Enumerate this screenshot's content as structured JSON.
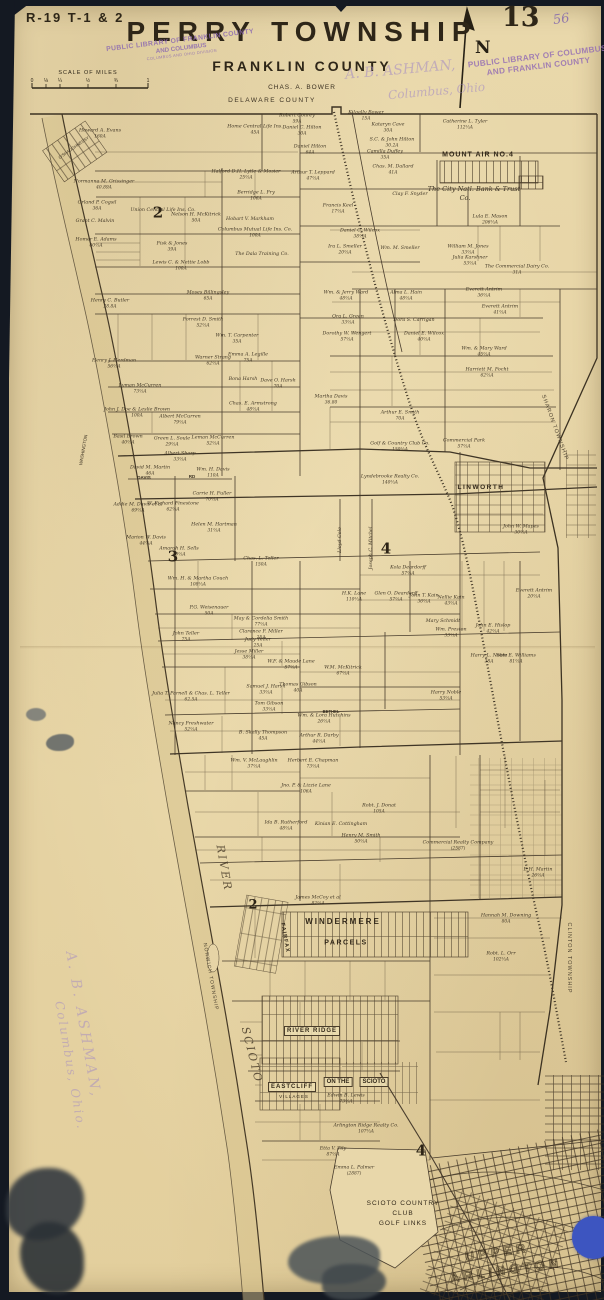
{
  "header": {
    "plate_ref": "R-19 T-1 & 2",
    "page_number": "13",
    "handwritten_number": "56",
    "title": "PERRY TOWNSHIP",
    "subtitle": "FRANKLIN COUNTY",
    "surveyor": "CHAS. A. BOWER",
    "north_label": "N",
    "county_line_label": "DELAWARE COUNTY"
  },
  "scale": {
    "caption": "SCALE OF MILES",
    "ticks": [
      "0",
      "⅛",
      "¼",
      "½",
      "¾",
      "1"
    ]
  },
  "stamps": {
    "library_left_1": "PUBLIC LIBRARY OF FRANKLIN COUNTY",
    "library_left_2": "AND COLUMBUS",
    "library_left_3": "COLUMBUS AND OHIO DIVISION",
    "library_right_1": "PUBLIC LIBRARY OF COLUMBUS",
    "library_right_2": "AND FRANKLIN COUNTY",
    "dealer_1": "A. B. ASHMAN,",
    "dealer_2": "Columbus, Ohio",
    "watermark_1": "A. B. ASHMAN,",
    "watermark_2": "Columbus, Ohio."
  },
  "map": {
    "accent_colors": {
      "paper": "#e6d4a6",
      "ink": "#3b3122",
      "stamp_purple": "#8d6bb1",
      "blue_dot": "#3d55c0"
    },
    "labels": [
      {
        "t": "SHARON TOWNSHIP",
        "x": 554,
        "y": 428,
        "cls": "boundary",
        "fs": 5.5,
        "rot": 70,
        "ls": 1
      },
      {
        "t": "CLINTON TOWNSHIP",
        "x": 568,
        "y": 958,
        "cls": "boundary",
        "fs": 5.5,
        "rot": 90,
        "ls": 1
      },
      {
        "t": "NORWICH TOWNSHIP",
        "x": 210,
        "y": 977,
        "cls": "boundary",
        "fs": 5,
        "rot": 80,
        "ls": 1
      },
      {
        "t": "RIVER",
        "x": 224,
        "y": 868,
        "cls": "river",
        "fs": 11,
        "rot": 80,
        "ls": 2
      },
      {
        "t": "SCIOTO",
        "x": 252,
        "y": 1055,
        "cls": "river",
        "fs": 11,
        "rot": 76,
        "ls": 2
      },
      {
        "t": "WASHINGTON",
        "x": 84,
        "y": 450,
        "cls": "road",
        "fs": 4.5,
        "rot": -80
      },
      {
        "t": "O'SHAUGHNESSY",
        "x": 74,
        "y": 148,
        "cls": "road",
        "fs": 4.2,
        "rot": -35
      },
      {
        "t": "MOUNT AIR NO.4",
        "x": 478,
        "y": 155,
        "cls": "place",
        "fs": 7,
        "ls": 1,
        "bold": 1
      },
      {
        "t": "The City Natl. Bank & Trust",
        "x": 474,
        "y": 189,
        "cls": "script",
        "fs": 6.5
      },
      {
        "t": "Co.",
        "x": 465,
        "y": 198,
        "cls": "script",
        "fs": 6.5
      },
      {
        "t": "LINWORTH",
        "x": 481,
        "y": 488,
        "cls": "place",
        "fs": 6.5,
        "ls": 1.5,
        "bold": 1
      },
      {
        "t": "WINDERMERE",
        "x": 343,
        "y": 922,
        "cls": "place",
        "fs": 8,
        "ls": 2,
        "bold": 1
      },
      {
        "t": "PARCELS",
        "x": 346,
        "y": 943,
        "cls": "place",
        "fs": 7,
        "ls": 1.5,
        "bold": 1
      },
      {
        "t": "FAIRFAX",
        "x": 284,
        "y": 938,
        "cls": "place",
        "fs": 5.5,
        "rot": 80,
        "ls": 1,
        "bold": 1
      },
      {
        "t": "RIVER RIDGE",
        "x": 312,
        "y": 1031,
        "cls": "place",
        "fs": 6,
        "ls": 1,
        "bold": 1,
        "box": 1
      },
      {
        "t": "EASTCLIFF",
        "x": 292,
        "y": 1087,
        "cls": "place",
        "fs": 6,
        "ls": 1,
        "bold": 1,
        "box": 1
      },
      {
        "t": "VILLAGES",
        "x": 294,
        "y": 1097,
        "cls": "place",
        "fs": 4.5,
        "ls": 1
      },
      {
        "t": "ON THE",
        "x": 338,
        "y": 1082,
        "cls": "place",
        "fs": 6,
        "bold": 1,
        "box": 1
      },
      {
        "t": "SCIOTO",
        "x": 374,
        "y": 1082,
        "cls": "place",
        "fs": 6,
        "bold": 1,
        "box": 1
      },
      {
        "t": "SCIOTO COUNTRY",
        "x": 403,
        "y": 1204,
        "cls": "place",
        "fs": 6.5,
        "ls": 1
      },
      {
        "t": "CLUB",
        "x": 403,
        "y": 1214,
        "cls": "place",
        "fs": 6.5,
        "ls": 1
      },
      {
        "t": "GOLF LINKS",
        "x": 403,
        "y": 1224,
        "cls": "place",
        "fs": 6.5,
        "ls": 1
      },
      {
        "t": "UPPER",
        "x": 497,
        "y": 1252,
        "cls": "outline",
        "fs": 13,
        "ls": 4,
        "rot": -8
      },
      {
        "t": "ARLINGTON",
        "x": 506,
        "y": 1270,
        "cls": "outline",
        "fs": 13,
        "ls": 4,
        "rot": -8
      },
      {
        "t": "DAVIS",
        "x": 144,
        "y": 478,
        "cls": "road",
        "fs": 4.5,
        "bold": 1
      },
      {
        "t": "RD",
        "x": 192,
        "y": 477,
        "cls": "road",
        "fs": 4.5,
        "bold": 1
      },
      {
        "t": "BETHEL",
        "x": 331,
        "y": 712,
        "cls": "road",
        "fs": 4.2,
        "bold": 1
      },
      {
        "t": "2",
        "x": 158,
        "y": 213,
        "cls": "section",
        "fs": 15
      },
      {
        "t": "3",
        "x": 173,
        "y": 557,
        "cls": "section",
        "fs": 15
      },
      {
        "t": "4",
        "x": 386,
        "y": 549,
        "cls": "section",
        "fs": 15
      },
      {
        "t": "2",
        "x": 253,
        "y": 905,
        "cls": "section",
        "fs": 13
      },
      {
        "t": "4",
        "x": 421,
        "y": 1151,
        "cls": "section",
        "fs": 15
      }
    ],
    "parcels": [
      {
        "n": "Howard A. Evans",
        "a": "160A",
        "x": 100,
        "y": 134
      },
      {
        "n": "Robert Conrey",
        "a": "59A",
        "x": 297,
        "y": 119
      },
      {
        "n": "Daniel C. Hilton",
        "a": "30A",
        "x": 302,
        "y": 131
      },
      {
        "n": "Daniel Hilton",
        "a": "64A",
        "x": 310,
        "y": 150
      },
      {
        "n": "Arthur T. Leppard",
        "a": "47⅔A",
        "x": 313,
        "y": 176
      },
      {
        "n": "Halford D.H. Lytle & Mosier",
        "a": "25⅔A",
        "x": 246,
        "y": 175
      },
      {
        "n": "Home Central Life Ins.",
        "a": "45A",
        "x": 255,
        "y": 130
      },
      {
        "n": "Kilgally Bower",
        "a": "15A",
        "x": 366,
        "y": 116
      },
      {
        "n": "Kataryn Cave",
        "a": "30A",
        "x": 388,
        "y": 128
      },
      {
        "n": "S.C. & John Hilton",
        "a": "30.2A",
        "x": 392,
        "y": 143
      },
      {
        "n": "Catherine L. Tyler",
        "a": "112⅔A",
        "x": 465,
        "y": 125
      },
      {
        "n": "Camilla Duffey",
        "a": "35A",
        "x": 385,
        "y": 155
      },
      {
        "n": "Chas. M. Dallard",
        "a": "41A",
        "x": 393,
        "y": 170
      },
      {
        "n": "Clay F. Snyder",
        "x": 410,
        "y": 195
      },
      {
        "n": "Berridge L. Fry",
        "a": "106A",
        "x": 256,
        "y": 196
      },
      {
        "n": "Hobart V. Markham",
        "x": 250,
        "y": 220
      },
      {
        "n": "Columbus Mutual Life Ins. Co.",
        "a": "100A",
        "x": 255,
        "y": 233
      },
      {
        "n": "The Dala Training Co.",
        "x": 262,
        "y": 255
      },
      {
        "n": "Union Central Life Ins. Co.",
        "x": 163,
        "y": 211
      },
      {
        "n": "Nelson H. McKitrick",
        "a": "50A",
        "x": 196,
        "y": 218
      },
      {
        "n": "Lewis C. & Nettie Lobb",
        "a": "100A",
        "x": 181,
        "y": 266
      },
      {
        "n": "Normanna M. Grissinger",
        "a": "40.89A",
        "x": 104,
        "y": 185
      },
      {
        "n": "Orland P. Cogsil",
        "a": "36A",
        "x": 97,
        "y": 206
      },
      {
        "n": "Grant C. Malvin",
        "x": 95,
        "y": 222
      },
      {
        "n": "Homer E. Adams",
        "a": "60⅔A",
        "x": 96,
        "y": 243
      },
      {
        "n": "Fisk & Jones",
        "a": "39A",
        "x": 172,
        "y": 247
      },
      {
        "n": "Ira L. Smeller",
        "a": "20⅔A",
        "x": 345,
        "y": 250
      },
      {
        "n": "Wm. M. Smeller",
        "x": 400,
        "y": 249
      },
      {
        "n": "Daniel C. Wilcox",
        "a": "38⅔A",
        "x": 360,
        "y": 234
      },
      {
        "n": "Francis Keel",
        "a": "17⅔A",
        "x": 338,
        "y": 209
      },
      {
        "n": "Lula E. Mason",
        "a": "206⅔A",
        "x": 490,
        "y": 220
      },
      {
        "n": "William M. Jones",
        "a": "33⅔A",
        "x": 468,
        "y": 250
      },
      {
        "n": "Julia Karshner",
        "a": "53⅔A",
        "x": 470,
        "y": 261
      },
      {
        "n": "The Commercial Dairy Co.",
        "a": "31A",
        "x": 517,
        "y": 270
      },
      {
        "n": "Wm. & Jerry Ward",
        "a": "48⅔A",
        "x": 346,
        "y": 296
      },
      {
        "n": "Alma L. Hain",
        "a": "48⅔A",
        "x": 406,
        "y": 296
      },
      {
        "n": "Everett Antrim",
        "a": "36⅔A",
        "x": 484,
        "y": 293
      },
      {
        "n": "Everett Antrim",
        "a": "41⅔A",
        "x": 500,
        "y": 310
      },
      {
        "n": "Ora L. Green",
        "a": "33⅔A",
        "x": 348,
        "y": 320
      },
      {
        "n": "Dora S. Carrigan",
        "x": 414,
        "y": 321
      },
      {
        "n": "Daniel E. Wilcox",
        "a": "40⅔A",
        "x": 424,
        "y": 337
      },
      {
        "n": "Wm. & Mary Ward",
        "a": "45⅔A",
        "x": 484,
        "y": 352
      },
      {
        "n": "Harriett M. Focht",
        "a": "62⅔A",
        "x": 487,
        "y": 373
      },
      {
        "n": "Dorothy W. Wengert",
        "a": "57⅓A",
        "x": 347,
        "y": 337
      },
      {
        "n": "Martha Davis",
        "a": "36.80",
        "x": 331,
        "y": 400
      },
      {
        "n": "Arthur E. Smith",
        "a": "70A",
        "x": 400,
        "y": 416
      },
      {
        "n": "Moses Billingsley",
        "a": "65A",
        "x": 208,
        "y": 296
      },
      {
        "n": "Forrest D. Smith",
        "a": "52⅔A",
        "x": 203,
        "y": 323
      },
      {
        "n": "Wm. T. Carpenter",
        "a": "35A",
        "x": 237,
        "y": 339
      },
      {
        "n": "Emma A. Legille",
        "a": "75A",
        "x": 248,
        "y": 358
      },
      {
        "n": "Bona Harsh",
        "x": 243,
        "y": 380
      },
      {
        "n": "Dave O. Harsh",
        "a": "70A",
        "x": 278,
        "y": 384
      },
      {
        "n": "Chas. E. Armstrong",
        "a": "48⅔A",
        "x": 253,
        "y": 407
      },
      {
        "n": "Henry C. Butler",
        "a": "28.8A",
        "x": 110,
        "y": 304
      },
      {
        "n": "Warner Strang",
        "a": "62⅔A",
        "x": 213,
        "y": 361
      },
      {
        "n": "Henry J. Herdman",
        "a": "56⅔A",
        "x": 114,
        "y": 364
      },
      {
        "n": "Lyman McCurren",
        "a": "73⅓A",
        "x": 140,
        "y": 389
      },
      {
        "n": "John J. Doe & Leslie Brown",
        "a": "100A",
        "x": 137,
        "y": 413
      },
      {
        "n": "Albert McCurren",
        "a": "79⅓A",
        "x": 180,
        "y": 420
      },
      {
        "n": "Basil Brown",
        "a": "40⅔A",
        "x": 128,
        "y": 440
      },
      {
        "n": "Green L. Soule",
        "a": "29⅔A",
        "x": 172,
        "y": 442
      },
      {
        "n": "Leman McCurren",
        "a": "52⅓A",
        "x": 213,
        "y": 441
      },
      {
        "n": "Albert Sharp",
        "a": "33⅔A",
        "x": 180,
        "y": 457
      },
      {
        "n": "David M. Martin",
        "a": "46A",
        "x": 150,
        "y": 471
      },
      {
        "n": "Wm. H. Davis",
        "a": "110A",
        "x": 213,
        "y": 473
      },
      {
        "n": "Addie M. Davis et al",
        "a": "69⅔A",
        "x": 138,
        "y": 508
      },
      {
        "n": "W. Richard Finestone",
        "a": "62⅔A",
        "x": 173,
        "y": 507
      },
      {
        "n": "Carrie H. Fuller",
        "a": "70⅔A",
        "x": 212,
        "y": 497
      },
      {
        "n": "Helen M. Hartman",
        "a": "31⅔A",
        "x": 214,
        "y": 528
      },
      {
        "n": "Marion W. Davis",
        "a": "44⅔A",
        "x": 146,
        "y": 541
      },
      {
        "n": "Amarah H. Sells",
        "a": "40⅔A",
        "x": 179,
        "y": 552
      },
      {
        "n": "Wm. H. & Martha Couch",
        "a": "108⅔A",
        "x": 198,
        "y": 582
      },
      {
        "n": "Chas. L. Teller",
        "a": "150A",
        "x": 261,
        "y": 562
      },
      {
        "n": "Golf & Country Club Co.",
        "a": "150⅔A",
        "x": 400,
        "y": 447
      },
      {
        "n": "Lyndebrooke Realty Co.",
        "a": "140⅔A",
        "x": 390,
        "y": 480
      },
      {
        "n": "Commercial Park",
        "a": "57⅔A",
        "x": 464,
        "y": 444
      },
      {
        "n": "John W. Mapes",
        "a": "30⅔A",
        "x": 521,
        "y": 530
      },
      {
        "n": "Joseph C. Mitchel",
        "x": 372,
        "y": 548,
        "rot": -90
      },
      {
        "n": "Lloyd Cole",
        "x": 341,
        "y": 540,
        "rot": -90
      },
      {
        "n": "H.K. Lane",
        "a": "110⅔A",
        "x": 354,
        "y": 597
      },
      {
        "n": "Kola Deardorff",
        "a": "57⅔A",
        "x": 408,
        "y": 571
      },
      {
        "n": "Glen O. Deardorff",
        "a": "57⅔A",
        "x": 396,
        "y": 597
      },
      {
        "n": "John T. Kain",
        "a": "36⅔A",
        "x": 424,
        "y": 599
      },
      {
        "n": "Nellie Kain",
        "a": "43⅔A",
        "x": 451,
        "y": 601
      },
      {
        "n": "P.G. Weisenauer",
        "a": "50A",
        "x": 209,
        "y": 611
      },
      {
        "n": "May & Cordelia Smith",
        "a": "77⅓A",
        "x": 261,
        "y": 622
      },
      {
        "n": "Clarence F. Miller",
        "a": "25A",
        "x": 261,
        "y": 635
      },
      {
        "n": "Judy Teller",
        "a": "25A",
        "x": 258,
        "y": 643
      },
      {
        "n": "John Teller",
        "a": "75A",
        "x": 186,
        "y": 637
      },
      {
        "n": "Jesse Miller",
        "a": "38⅔A",
        "x": 249,
        "y": 655
      },
      {
        "n": "W.F. & Maude Lane",
        "a": "57⅓A",
        "x": 291,
        "y": 665
      },
      {
        "n": "W.M. McKitrick",
        "a": "67⅓A",
        "x": 343,
        "y": 671
      },
      {
        "n": "Samuel J. Harsh",
        "a": "33⅔A",
        "x": 266,
        "y": 690
      },
      {
        "n": "Thomas Gibson",
        "a": "40A",
        "x": 298,
        "y": 688
      },
      {
        "n": "Tom Gibson",
        "a": "33⅓A",
        "x": 269,
        "y": 707
      },
      {
        "n": "Julia T. Parnell & Chas. L. Teller",
        "a": "62.5A",
        "x": 191,
        "y": 697
      },
      {
        "n": "Nancy Freshwater",
        "a": "52⅓A",
        "x": 191,
        "y": 727
      },
      {
        "n": "B. Skelly Thompson",
        "a": "45A",
        "x": 263,
        "y": 736
      },
      {
        "n": "Arthur R. Darby",
        "a": "44⅓A",
        "x": 319,
        "y": 739
      },
      {
        "n": "Wm. & Lora Hutchins",
        "a": "26⅔A",
        "x": 324,
        "y": 719
      },
      {
        "n": "Wm. V. McLaughlin",
        "a": "37⅔A",
        "x": 254,
        "y": 764
      },
      {
        "n": "Herbert E. Chapman",
        "a": "73⅓A",
        "x": 313,
        "y": 764
      },
      {
        "n": "Mary Schmidt",
        "x": 443,
        "y": 622
      },
      {
        "n": "Wm. Preston",
        "a": "33⅔A",
        "x": 451,
        "y": 633
      },
      {
        "n": "Everett Antrim",
        "a": "20⅔A",
        "x": 534,
        "y": 594
      },
      {
        "n": "John E. Hislop",
        "a": "42⅔A",
        "x": 493,
        "y": 629
      },
      {
        "n": "Harry L. Noble",
        "a": "38A",
        "x": 489,
        "y": 659
      },
      {
        "n": "Sam E. Williams",
        "a": "81⅔A",
        "x": 516,
        "y": 659
      },
      {
        "n": "Harry Noble",
        "a": "53⅔A",
        "x": 446,
        "y": 696
      },
      {
        "n": "Jno. P. & Lizzie Lane",
        "a": "106A",
        "x": 306,
        "y": 789
      },
      {
        "n": "Robt. J. Donat",
        "a": "105A",
        "x": 379,
        "y": 809
      },
      {
        "n": "Ida B. Rutherford",
        "a": "48⅔A",
        "x": 286,
        "y": 826
      },
      {
        "n": "Kinian E. Cottingham",
        "x": 341,
        "y": 825
      },
      {
        "n": "Henry M. Smith",
        "a": "50⅔A",
        "x": 361,
        "y": 839
      },
      {
        "n": "Commercial Realty Company",
        "a": "(2587)",
        "x": 458,
        "y": 846
      },
      {
        "n": "James McCoy et al",
        "a": "82⅔A",
        "x": 318,
        "y": 901
      },
      {
        "n": "E.H. Martin",
        "a": "26⅔A",
        "x": 538,
        "y": 873
      },
      {
        "n": "Hannah M. Downing",
        "a": "80A",
        "x": 506,
        "y": 919
      },
      {
        "n": "Robt. L. Orr",
        "a": "102⅔A",
        "x": 501,
        "y": 957
      },
      {
        "n": "Edwin B. Lewis",
        "a": "73⅔A",
        "x": 346,
        "y": 1099
      },
      {
        "n": "Arlington Ridge Realty Co.",
        "a": "107⅔A",
        "x": 366,
        "y": 1129
      },
      {
        "n": "Etta V. Tily",
        "a": "87⅔A",
        "x": 333,
        "y": 1152
      },
      {
        "n": "Emma L. Palmer",
        "a": "(2887)",
        "x": 354,
        "y": 1171
      }
    ]
  }
}
